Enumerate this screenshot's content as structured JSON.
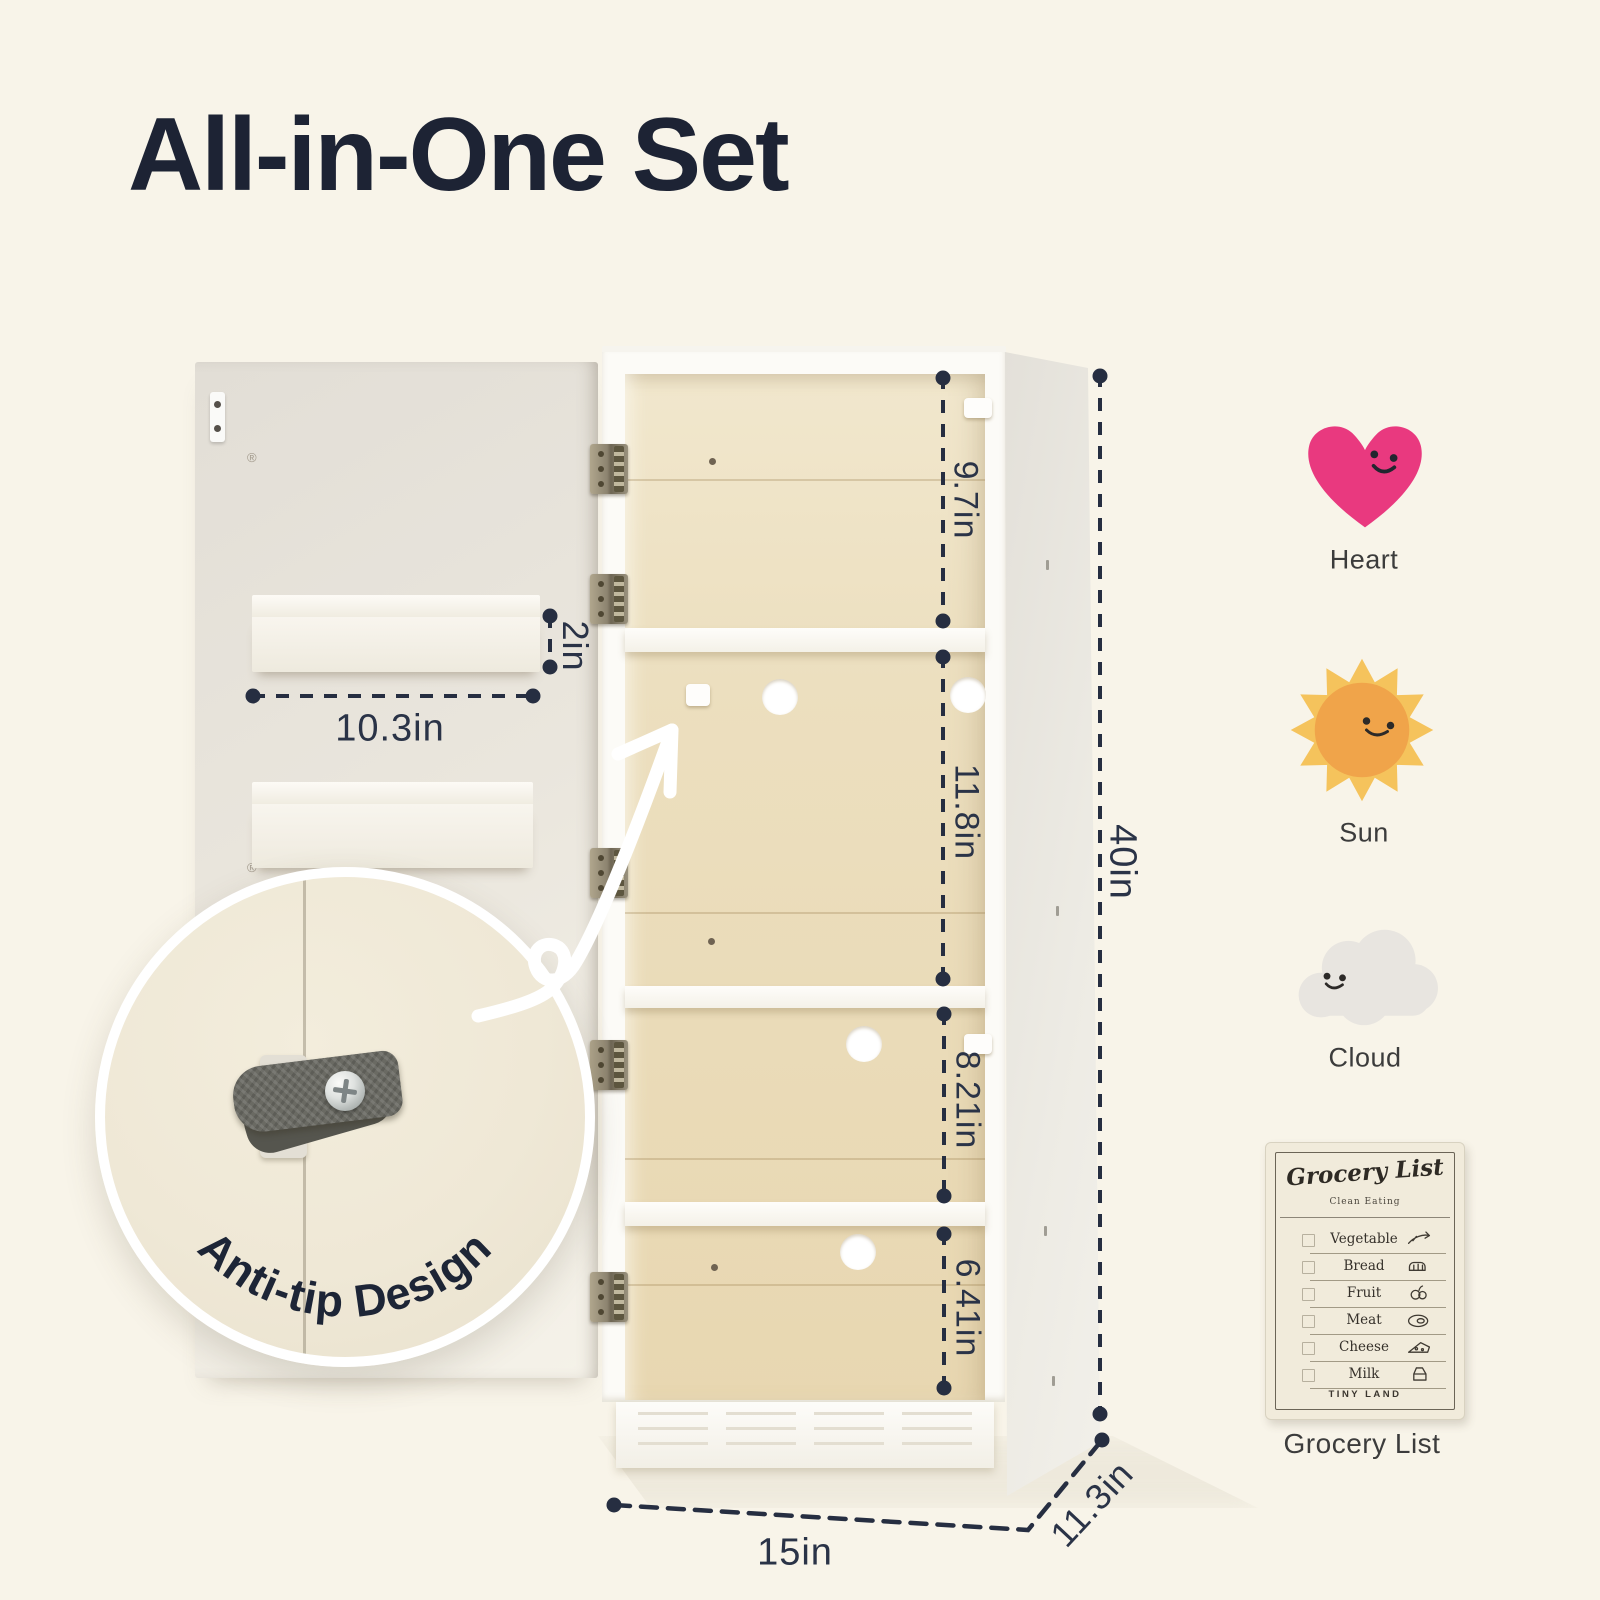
{
  "title": "All-in-One Set",
  "colors": {
    "background": "#f8f4e9",
    "ink_navy": "#262e41",
    "heart": "#e9397f",
    "sun_rays": "#f5c35c",
    "sun_core": "#f0a44a",
    "cloud": "#e8e5e0",
    "interior_wood": "#ecdfbf"
  },
  "dimensions": {
    "compartment_heights": [
      {
        "label": "9.7in"
      },
      {
        "label": "11.8in"
      },
      {
        "label": "8.21in"
      },
      {
        "label": "6.41in"
      }
    ],
    "overall_height": {
      "label": "40in"
    },
    "width": {
      "label": "15in"
    },
    "depth": {
      "label": "11.3in"
    },
    "door_shelf_depth": {
      "label": "2in"
    },
    "door_shelf_width": {
      "label": "10.3in"
    }
  },
  "callout": {
    "label": "Anti-tip Design"
  },
  "accessories": [
    {
      "name": "Heart",
      "icon": "heart-icon",
      "color": "#e9397f"
    },
    {
      "name": "Sun",
      "icon": "sun-icon",
      "color": "#f0a44a"
    },
    {
      "name": "Cloud",
      "icon": "cloud-icon",
      "color": "#e8e5e0"
    }
  ],
  "grocery_card": {
    "title": "Grocery List",
    "subtitle": "Clean Eating",
    "items": [
      {
        "name": "Vegetable",
        "icon": "vegetable-icon"
      },
      {
        "name": "Bread",
        "icon": "bread-icon"
      },
      {
        "name": "Fruit",
        "icon": "fruit-icon"
      },
      {
        "name": "Meat",
        "icon": "meat-icon"
      },
      {
        "name": "Cheese",
        "icon": "cheese-icon"
      },
      {
        "name": "Milk",
        "icon": "milk-icon"
      }
    ],
    "brand": "TINY LAND",
    "caption": "Grocery List"
  }
}
